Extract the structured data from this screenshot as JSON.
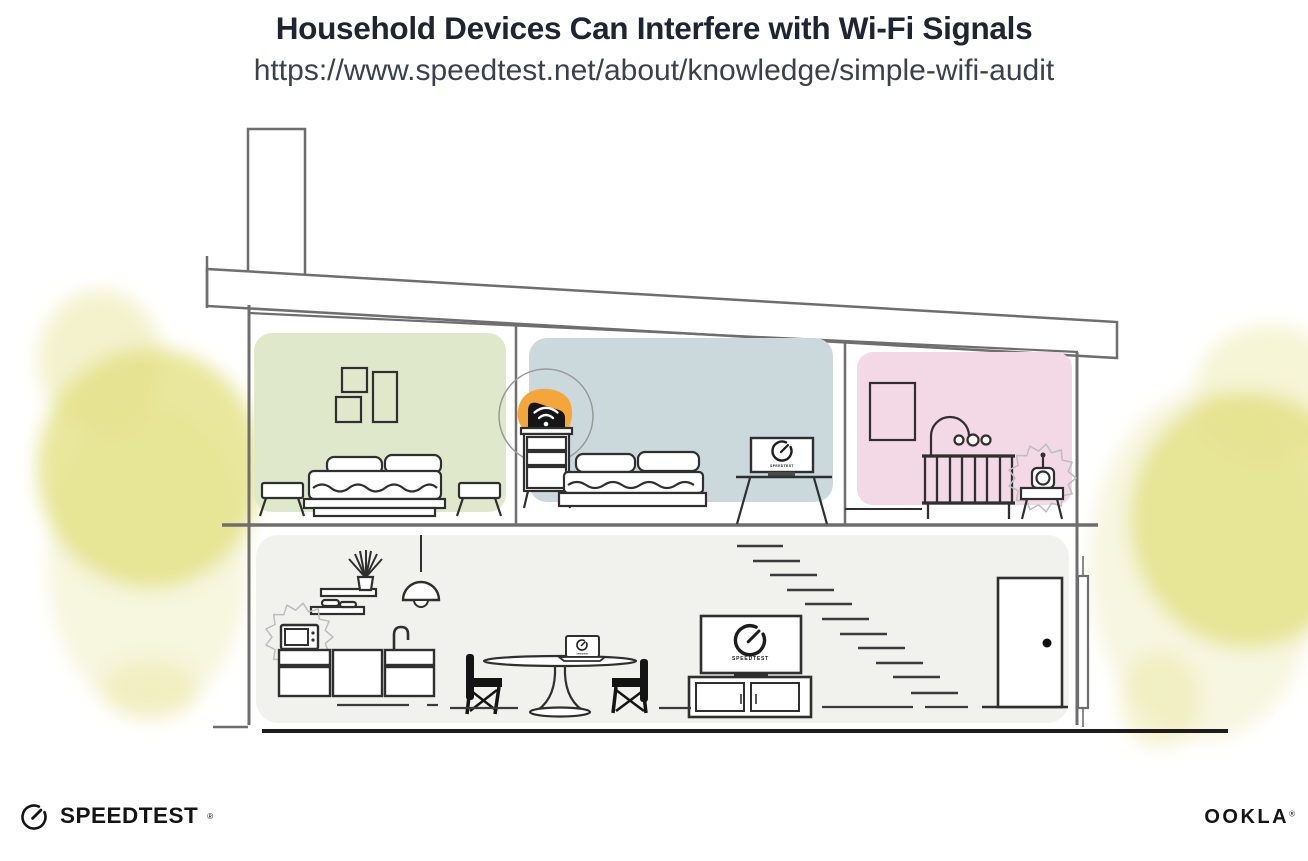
{
  "header": {
    "title": "Household Devices Can Interfere with Wi-Fi Signals",
    "url": "https://www.speedtest.net/about/knowledge/simple-wifi-audit"
  },
  "house": {
    "screens": {
      "tv_label": "SPEEDTEST",
      "desk_monitor_label": "SPEEDTEST",
      "dining_laptop_label": "SPEEDTEST"
    }
  },
  "footer": {
    "speedtest_wordmark": "SPEEDTEST",
    "speedtest_reg_mark": "®",
    "ookla_wordmark": "OOKLA",
    "ookla_reg_mark": "®"
  },
  "colors": {
    "title_ink": "#1e2431",
    "subtitle_ink": "#3a414d",
    "structure_line": "#6e6e6e",
    "furniture_line": "#2f2f2f",
    "accent_orange": "#F5A63B",
    "router_black": "#161616",
    "room_green": "#DFE8CB",
    "room_blue": "#CBD9DD",
    "room_pink": "#F3D8E5",
    "ground_floor_gray": "#F1F1EE",
    "foliage_yellow": "#E4E184",
    "foliage_yellow_light": "#F0EEC2",
    "interference_gray": "#BDBDBD",
    "logo_black": "#141414"
  }
}
